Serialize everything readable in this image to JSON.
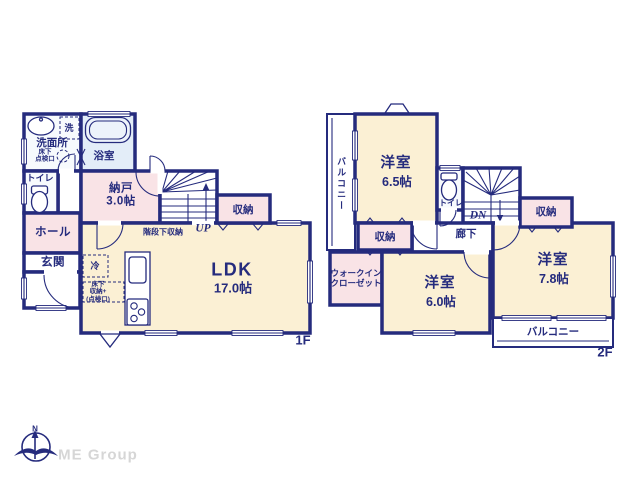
{
  "colors": {
    "wall": "#252b7d",
    "room_cream": "#fbf0d4",
    "room_pink": "#f9e3e6",
    "bath_blue": "#e3edf8",
    "room_white": "#f7fafd",
    "brand_gray": "#d6d6d6"
  },
  "floor1": {
    "floor_label": "1F",
    "rooms": {
      "washer": "洗",
      "washroom": "洗面所",
      "underfloor_hatch": "床下\n点検口",
      "bath": "浴室",
      "toilet": "トイレ",
      "storage_room": "納戸",
      "storage_room_size": "3.0帖",
      "under_stair_storage": "階段下収納",
      "stairs_up": "UP",
      "closet": "収納",
      "hall": "ホール",
      "entrance": "玄関",
      "fridge": "冷",
      "underfloor_storage": "床下\n収納+\n(点検口)",
      "ldk": "LDK",
      "ldk_size": "17.0帖"
    }
  },
  "floor2": {
    "floor_label": "2F",
    "rooms": {
      "balcony_side": "バルコニー",
      "bedroom_a": "洋室",
      "bedroom_a_size": "6.5帖",
      "toilet": "トイレ",
      "stairs_down": "DN",
      "closet_east": "収納",
      "corridor": "廊下",
      "closet_center": "収納",
      "walk_in_closet": "ウォークイン\nクローゼット",
      "bedroom_b": "洋室",
      "bedroom_b_size": "6.0帖",
      "bedroom_c": "洋室",
      "bedroom_c_size": "7.8帖",
      "balcony_south": "バルコニー"
    }
  },
  "footer": {
    "compass_north": "N",
    "brand": "ME Group"
  }
}
